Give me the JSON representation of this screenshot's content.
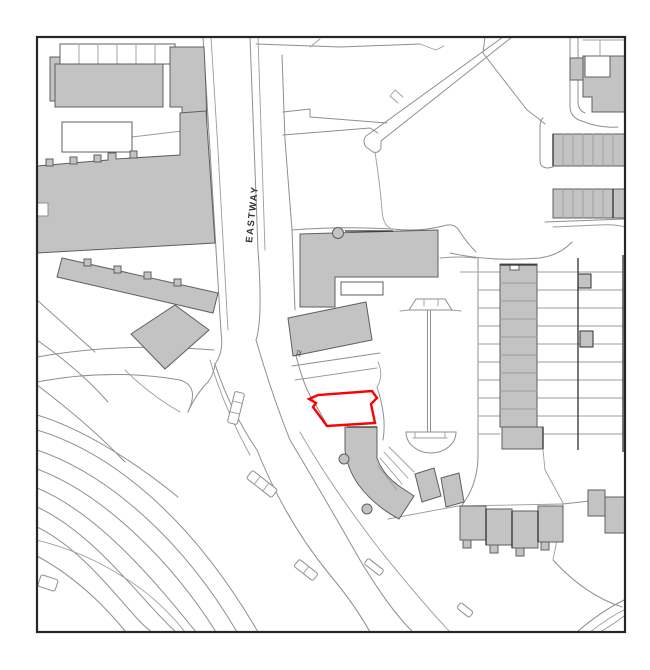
{
  "map": {
    "labels": {
      "road": "EASTWAY",
      "building_number": "32"
    },
    "colors": {
      "background": "#ffffff",
      "line": "#8f8f8f",
      "building_fill": "#c3c3c3",
      "building_stroke": "#5f5f5f",
      "site_boundary": "#fe0000",
      "frame": "#262626",
      "label": "#333333"
    },
    "site_boundary_points": "309,399 318,395 372,391 377,398 371,404 375,423 327,426 313,407 316,403"
  }
}
